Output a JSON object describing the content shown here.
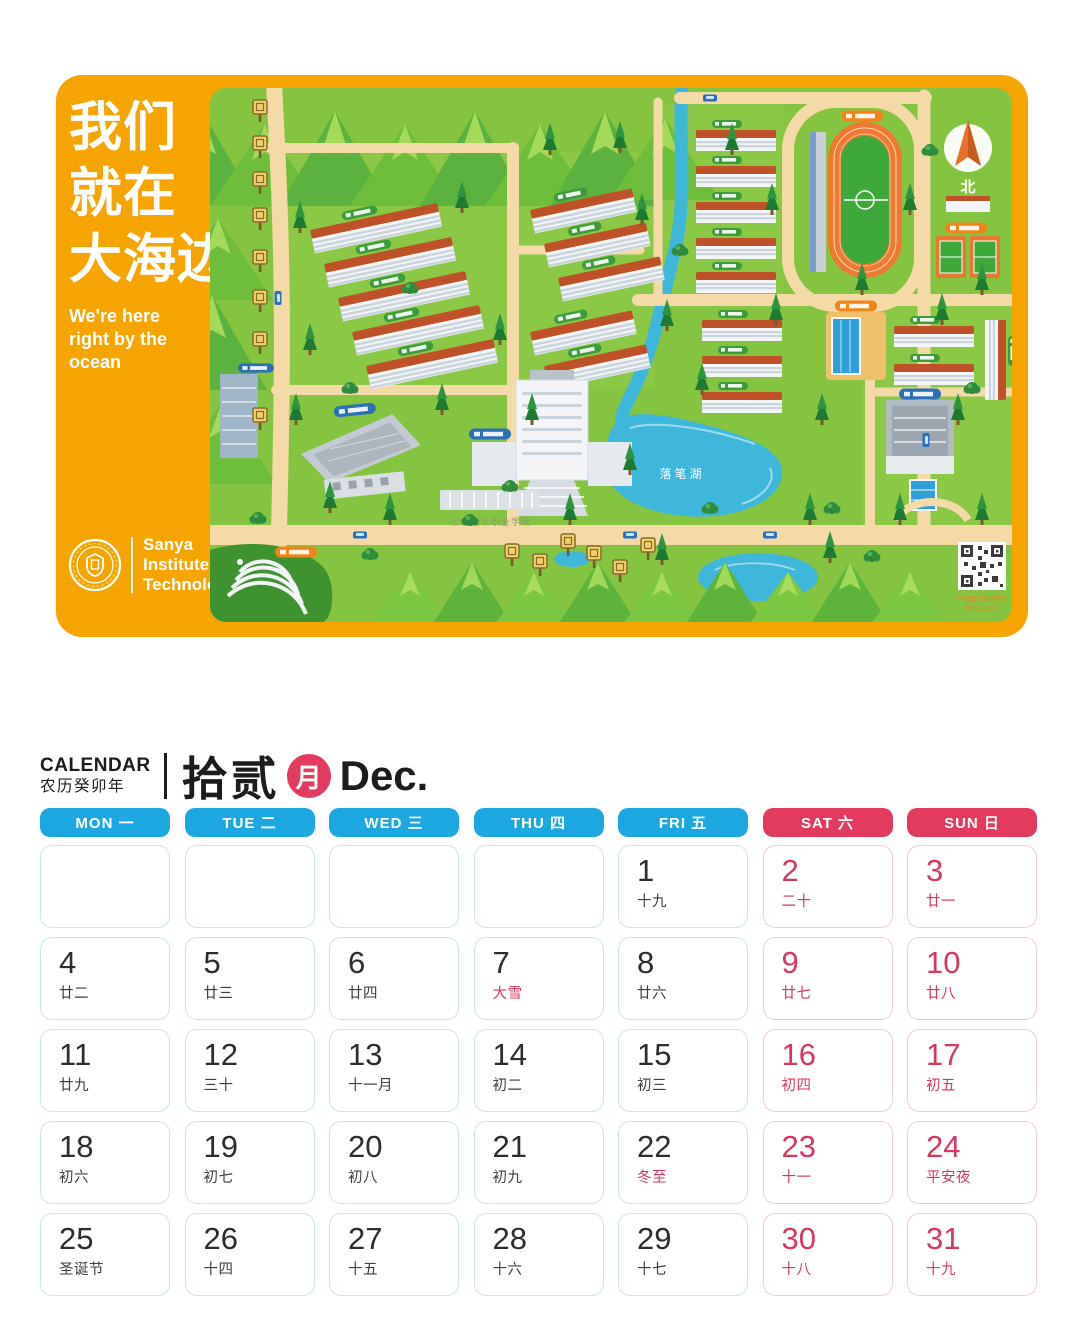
{
  "map_card": {
    "slogan_cn": [
      "我们",
      "就在",
      "大海边"
    ],
    "slogan_en": [
      "We're here",
      "right by the ocean"
    ],
    "logo_lines": [
      "Sanya",
      "Institute of",
      "Technology"
    ],
    "map_labels": {
      "compass": "北",
      "lake": "落笔湖",
      "campus": "三亚理工职业学院",
      "qr_caption_1": "三亚理工职业学院",
      "qr_caption_2": "微信公众号"
    }
  },
  "calendar": {
    "title_en": "CALENDAR",
    "title_cn": "农历癸卯年",
    "month_cn": "拾贰",
    "month_badge": "月",
    "month_abbr": "Dec.",
    "weekdays": [
      {
        "label": "MON 一",
        "weekend": false
      },
      {
        "label": "TUE 二",
        "weekend": false
      },
      {
        "label": "WED 三",
        "weekend": false
      },
      {
        "label": "THU 四",
        "weekend": false
      },
      {
        "label": "FRI 五",
        "weekend": false
      },
      {
        "label": "SAT 六",
        "weekend": true
      },
      {
        "label": "SUN 日",
        "weekend": true
      }
    ],
    "cells": [
      {
        "day": "",
        "lunar": "",
        "day_red": false,
        "lunar_red": false,
        "weekend": false
      },
      {
        "day": "",
        "lunar": "",
        "day_red": false,
        "lunar_red": false,
        "weekend": false
      },
      {
        "day": "",
        "lunar": "",
        "day_red": false,
        "lunar_red": false,
        "weekend": false
      },
      {
        "day": "",
        "lunar": "",
        "day_red": false,
        "lunar_red": false,
        "weekend": false
      },
      {
        "day": "1",
        "lunar": "十九",
        "day_red": false,
        "lunar_red": false,
        "weekend": false
      },
      {
        "day": "2",
        "lunar": "二十",
        "day_red": true,
        "lunar_red": true,
        "weekend": true
      },
      {
        "day": "3",
        "lunar": "廿一",
        "day_red": true,
        "lunar_red": true,
        "weekend": true
      },
      {
        "day": "4",
        "lunar": "廿二",
        "day_red": false,
        "lunar_red": false,
        "weekend": false
      },
      {
        "day": "5",
        "lunar": "廿三",
        "day_red": false,
        "lunar_red": false,
        "weekend": false
      },
      {
        "day": "6",
        "lunar": "廿四",
        "day_red": false,
        "lunar_red": false,
        "weekend": false
      },
      {
        "day": "7",
        "lunar": "大雪",
        "day_red": false,
        "lunar_red": true,
        "weekend": false
      },
      {
        "day": "8",
        "lunar": "廿六",
        "day_red": false,
        "lunar_red": false,
        "weekend": false
      },
      {
        "day": "9",
        "lunar": "廿七",
        "day_red": true,
        "lunar_red": true,
        "weekend": true
      },
      {
        "day": "10",
        "lunar": "廿八",
        "day_red": true,
        "lunar_red": true,
        "weekend": true
      },
      {
        "day": "11",
        "lunar": "廿九",
        "day_red": false,
        "lunar_red": false,
        "weekend": false
      },
      {
        "day": "12",
        "lunar": "三十",
        "day_red": false,
        "lunar_red": false,
        "weekend": false
      },
      {
        "day": "13",
        "lunar": "十一月",
        "day_red": false,
        "lunar_red": false,
        "weekend": false
      },
      {
        "day": "14",
        "lunar": "初二",
        "day_red": false,
        "lunar_red": false,
        "weekend": false
      },
      {
        "day": "15",
        "lunar": "初三",
        "day_red": false,
        "lunar_red": false,
        "weekend": false
      },
      {
        "day": "16",
        "lunar": "初四",
        "day_red": true,
        "lunar_red": true,
        "weekend": true
      },
      {
        "day": "17",
        "lunar": "初五",
        "day_red": true,
        "lunar_red": true,
        "weekend": true
      },
      {
        "day": "18",
        "lunar": "初六",
        "day_red": false,
        "lunar_red": false,
        "weekend": false
      },
      {
        "day": "19",
        "lunar": "初七",
        "day_red": false,
        "lunar_red": false,
        "weekend": false
      },
      {
        "day": "20",
        "lunar": "初八",
        "day_red": false,
        "lunar_red": false,
        "weekend": false
      },
      {
        "day": "21",
        "lunar": "初九",
        "day_red": false,
        "lunar_red": false,
        "weekend": false
      },
      {
        "day": "22",
        "lunar": "冬至",
        "day_red": false,
        "lunar_red": true,
        "weekend": false
      },
      {
        "day": "23",
        "lunar": "十一",
        "day_red": true,
        "lunar_red": true,
        "weekend": true
      },
      {
        "day": "24",
        "lunar": "平安夜",
        "day_red": true,
        "lunar_red": true,
        "weekend": true
      },
      {
        "day": "25",
        "lunar": "圣诞节",
        "day_red": false,
        "lunar_red": false,
        "weekend": false
      },
      {
        "day": "26",
        "lunar": "十四",
        "day_red": false,
        "lunar_red": false,
        "weekend": false
      },
      {
        "day": "27",
        "lunar": "十五",
        "day_red": false,
        "lunar_red": false,
        "weekend": false
      },
      {
        "day": "28",
        "lunar": "十六",
        "day_red": false,
        "lunar_red": false,
        "weekend": false
      },
      {
        "day": "29",
        "lunar": "十七",
        "day_red": false,
        "lunar_red": false,
        "weekend": false
      },
      {
        "day": "30",
        "lunar": "十八",
        "day_red": true,
        "lunar_red": true,
        "weekend": true
      },
      {
        "day": "31",
        "lunar": "十九",
        "day_red": true,
        "lunar_red": true,
        "weekend": true
      }
    ]
  },
  "colors": {
    "orange": "#F6A402",
    "blue": "#1CA7E1",
    "crimson": "#E23B5F",
    "red_text": "#D8375D"
  }
}
